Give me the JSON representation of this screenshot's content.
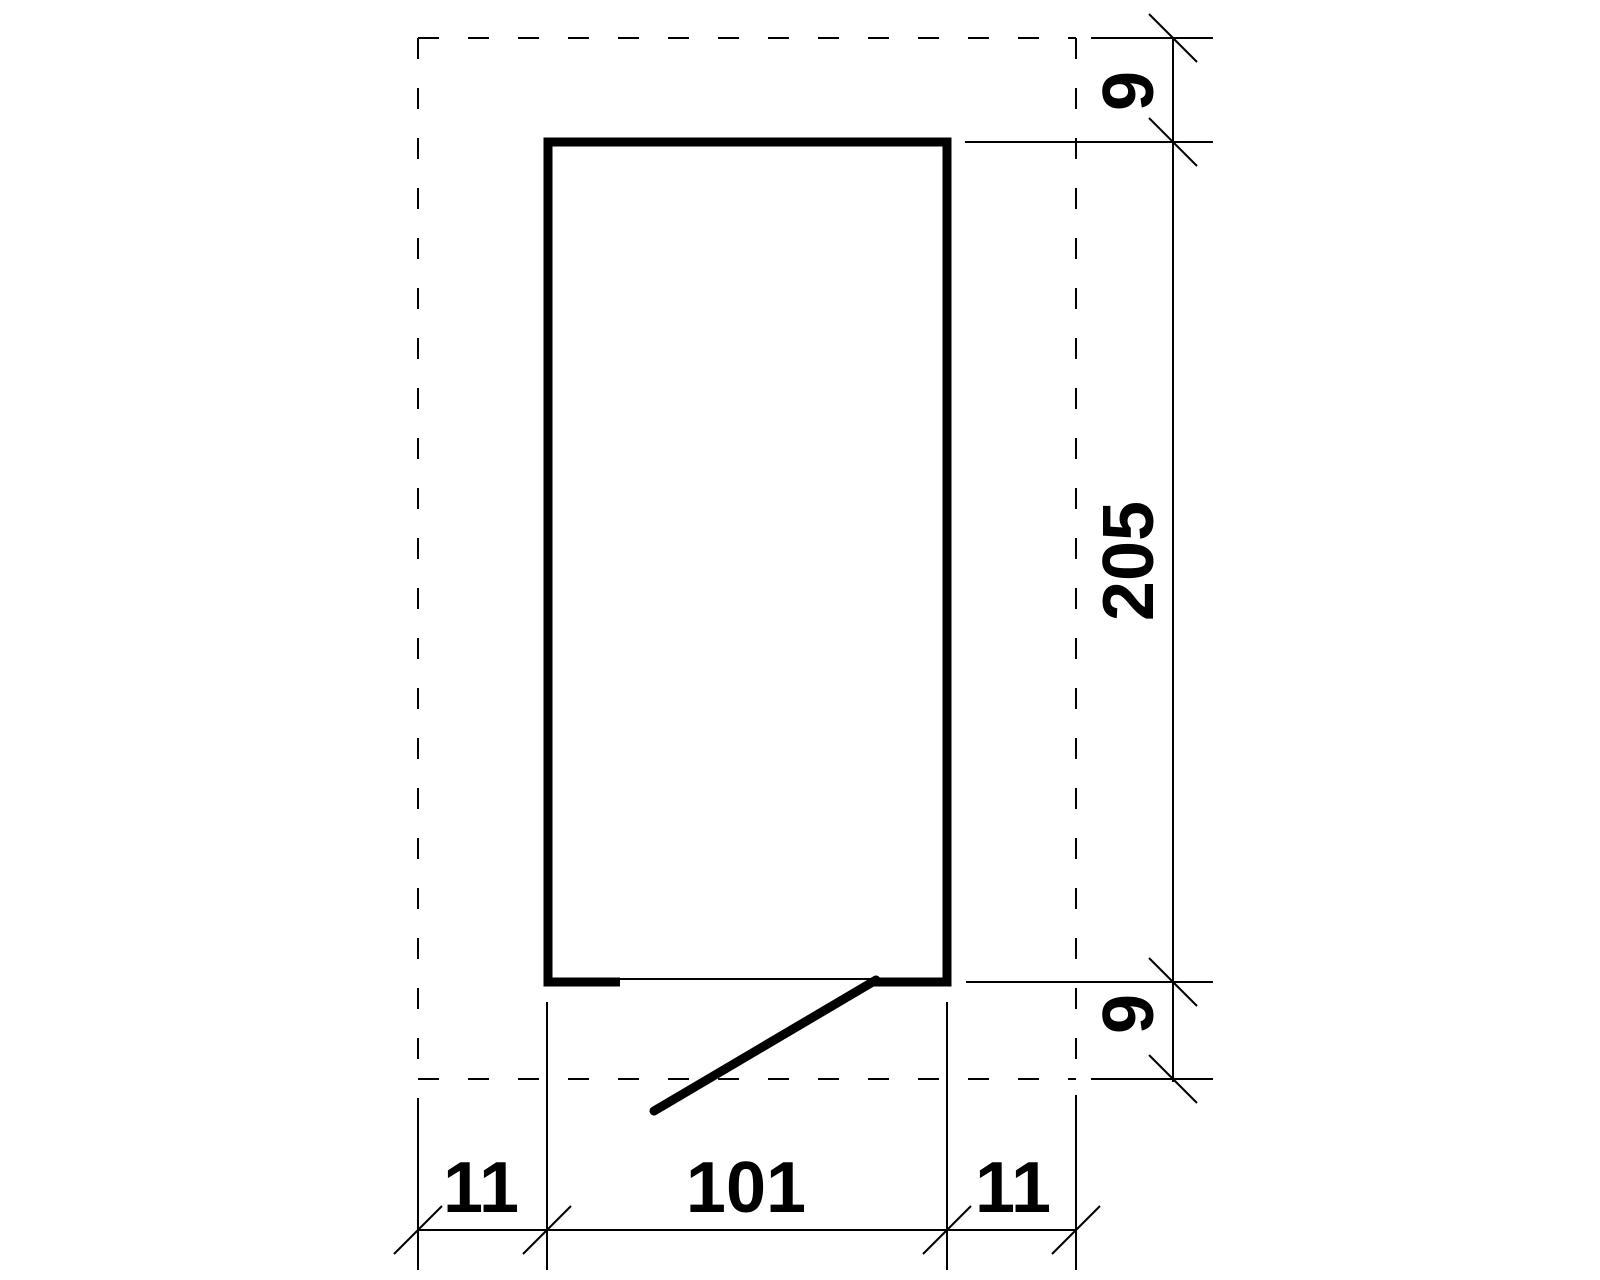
{
  "drawing": {
    "labels": {
      "right_dimension": {
        "top": "9",
        "middle": "205",
        "bottom": "9"
      },
      "bottom_dimension": {
        "left": "11",
        "middle": "101",
        "right": "11"
      }
    },
    "colors": {
      "line": "#000000",
      "background": "#ffffff"
    }
  }
}
